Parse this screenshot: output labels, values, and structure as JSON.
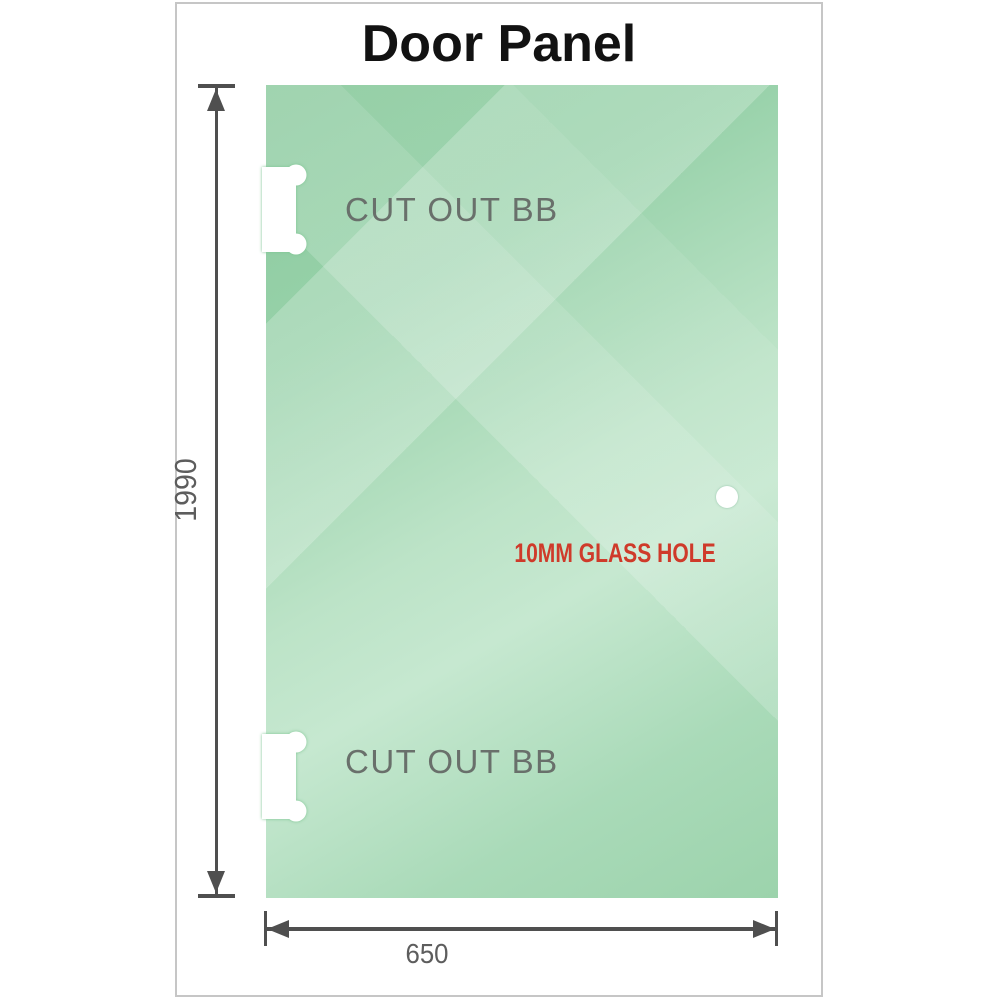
{
  "title": "Door Panel",
  "diagram": {
    "cutouts": [
      {
        "label": "CUT OUT BB",
        "position": "top-left"
      },
      {
        "label": "CUT OUT BB",
        "position": "bottom-left"
      }
    ],
    "glass_hole": {
      "label": "10MM GLASS HOLE"
    },
    "dimensions": {
      "height": "1990",
      "width": "650"
    }
  },
  "colors": {
    "glass_green_dark": "#8bca9e",
    "glass_green_light": "#c6e8d0",
    "glass_green_mid": "#a9dab8",
    "dimension_line": "#4f4f4f",
    "dimension_text": "#5d5d5d",
    "cutout_text": "#69706b",
    "hole_label_text": "#cf3a2a",
    "card_border": "#c6c6c6",
    "title_text": "#121212"
  }
}
